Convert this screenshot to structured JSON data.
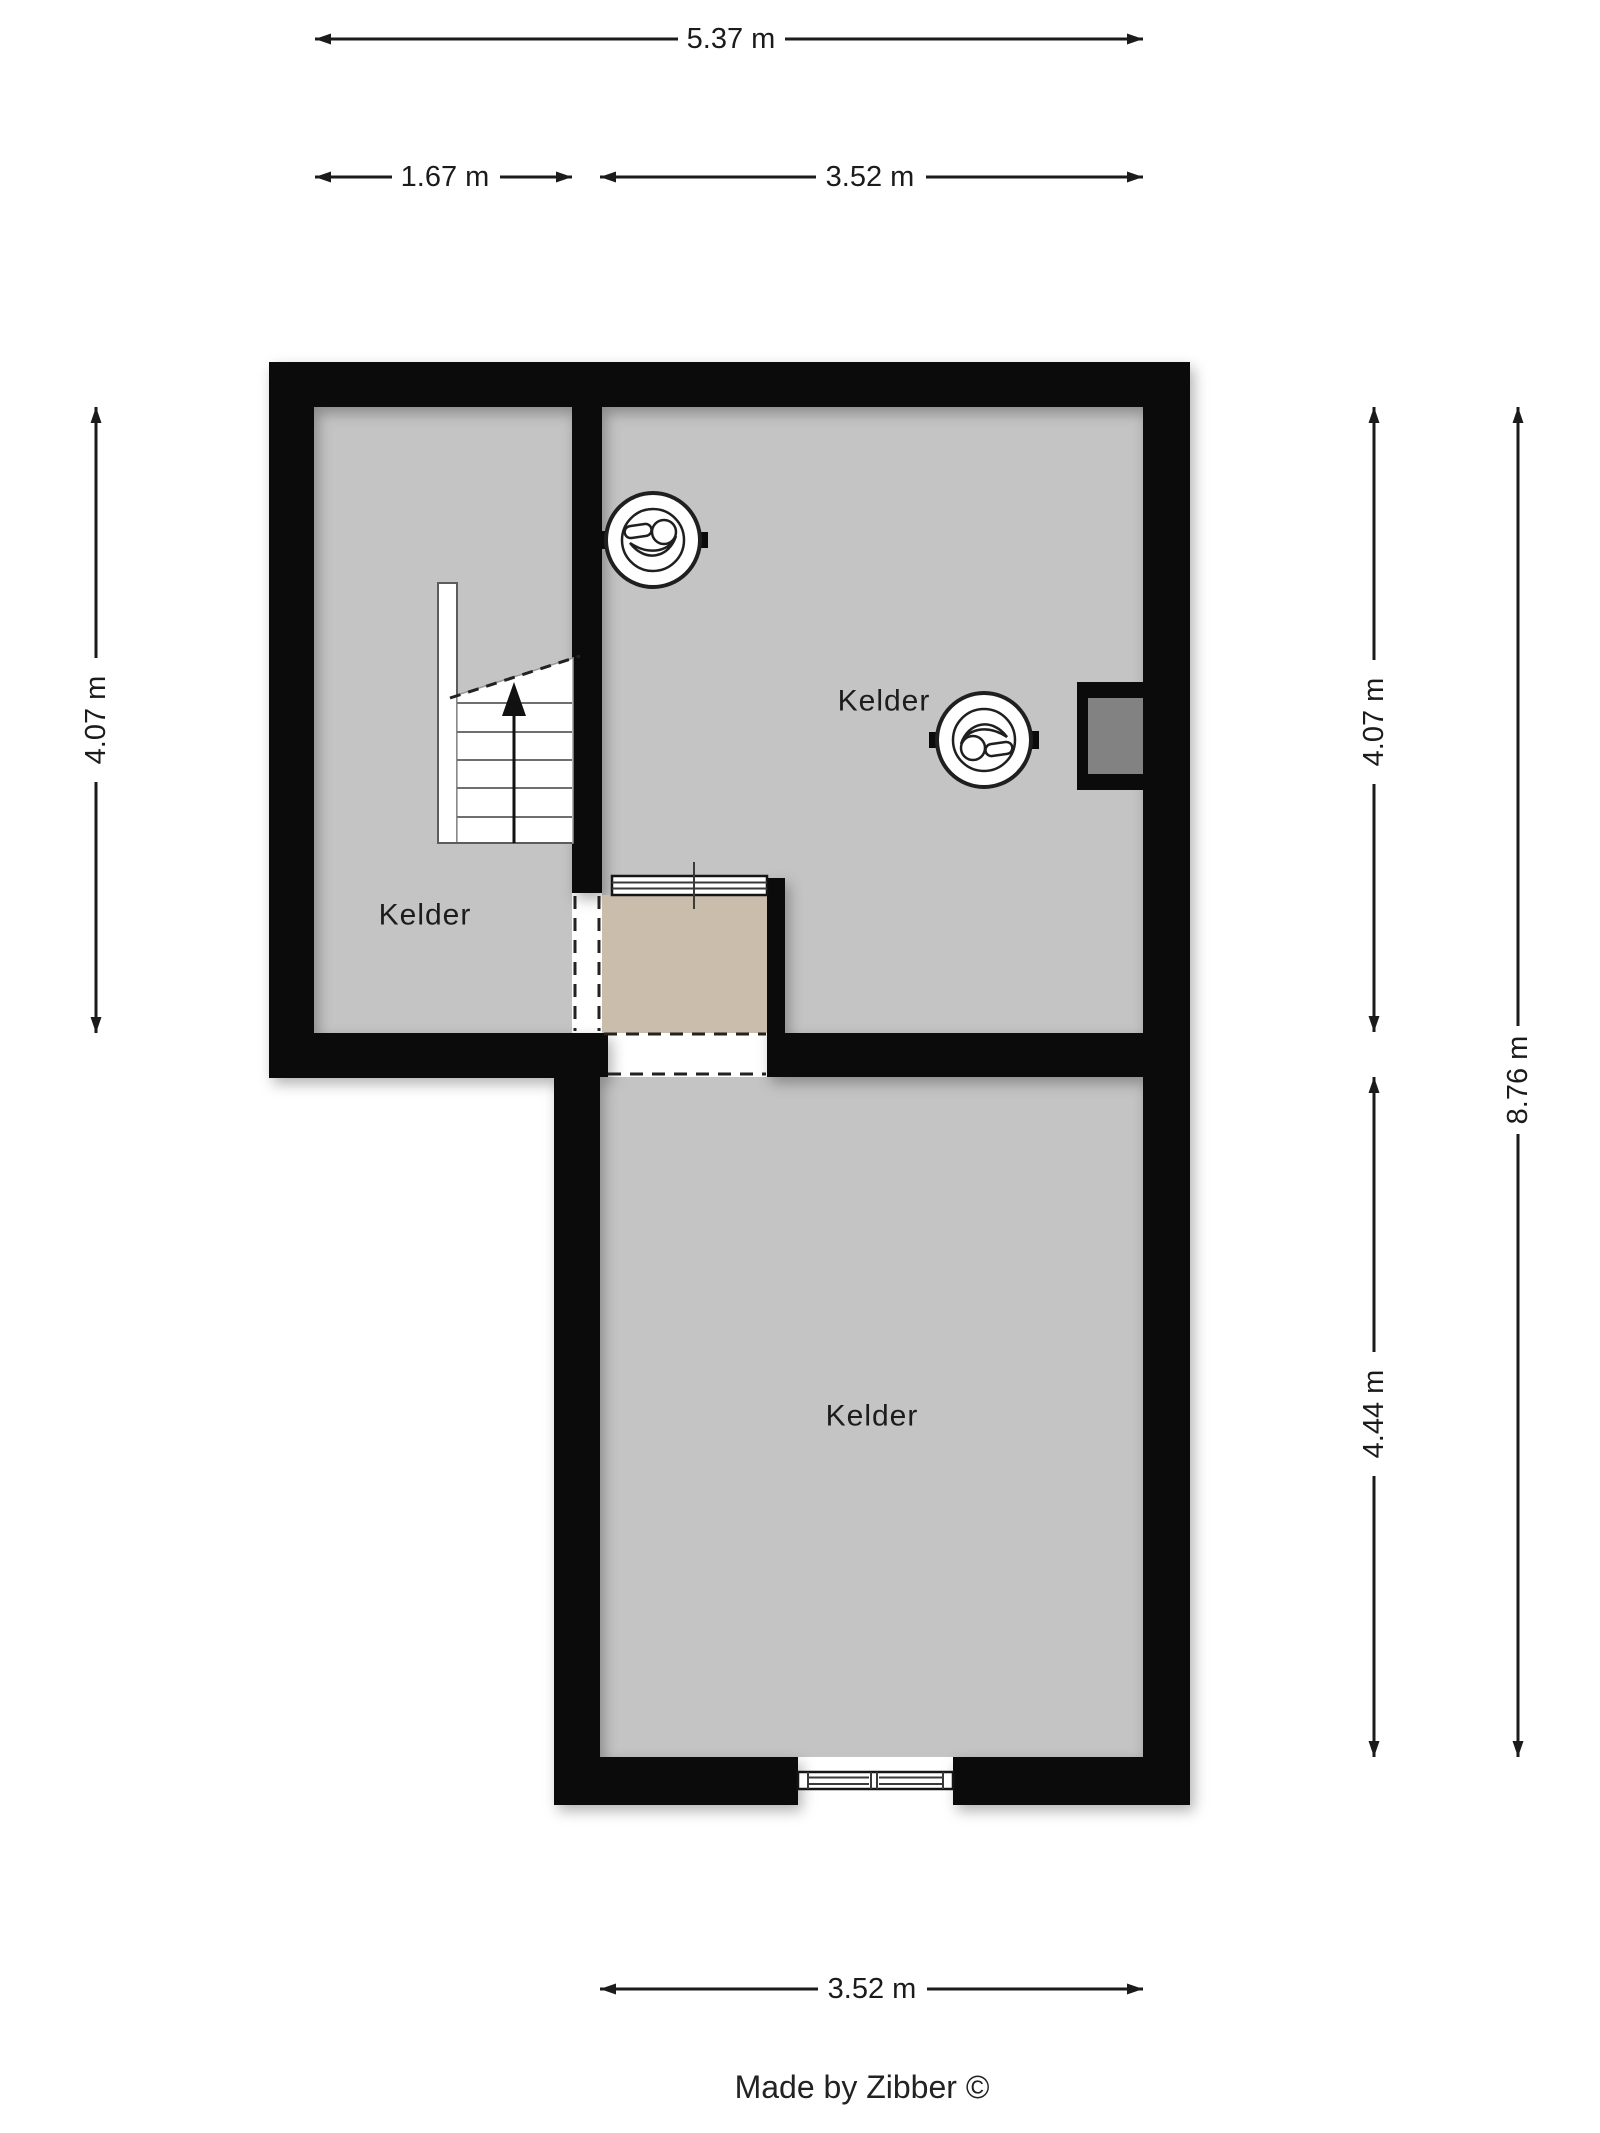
{
  "credit": "Made by Zibber ©",
  "rooms": {
    "left": {
      "label": "Kelder"
    },
    "upper": {
      "label": "Kelder"
    },
    "lower": {
      "label": "Kelder"
    }
  },
  "dimensions": {
    "top_total": "5.37 m",
    "top_left_segment": "1.67 m",
    "top_right_segment": "3.52 m",
    "left_height": "4.07 m",
    "right_upper_height": "4.07 m",
    "right_lower_height": "4.44 m",
    "right_total_height": "8.76 m",
    "bottom_width": "3.52 m"
  },
  "icons": {
    "upper_room_light_1": "ceiling-light-icon",
    "upper_room_light_2": "ceiling-light-icon",
    "stairs": "staircase-up-arrow",
    "niche": "wall-niche",
    "windows": "window-glazing"
  },
  "theme": {
    "bg": "#ffffff",
    "floor": "#c4c4c4",
    "wall": "#0b0b0b",
    "beige": "#cbbdab",
    "niche": "#828282",
    "line": "#1b1b1b"
  }
}
